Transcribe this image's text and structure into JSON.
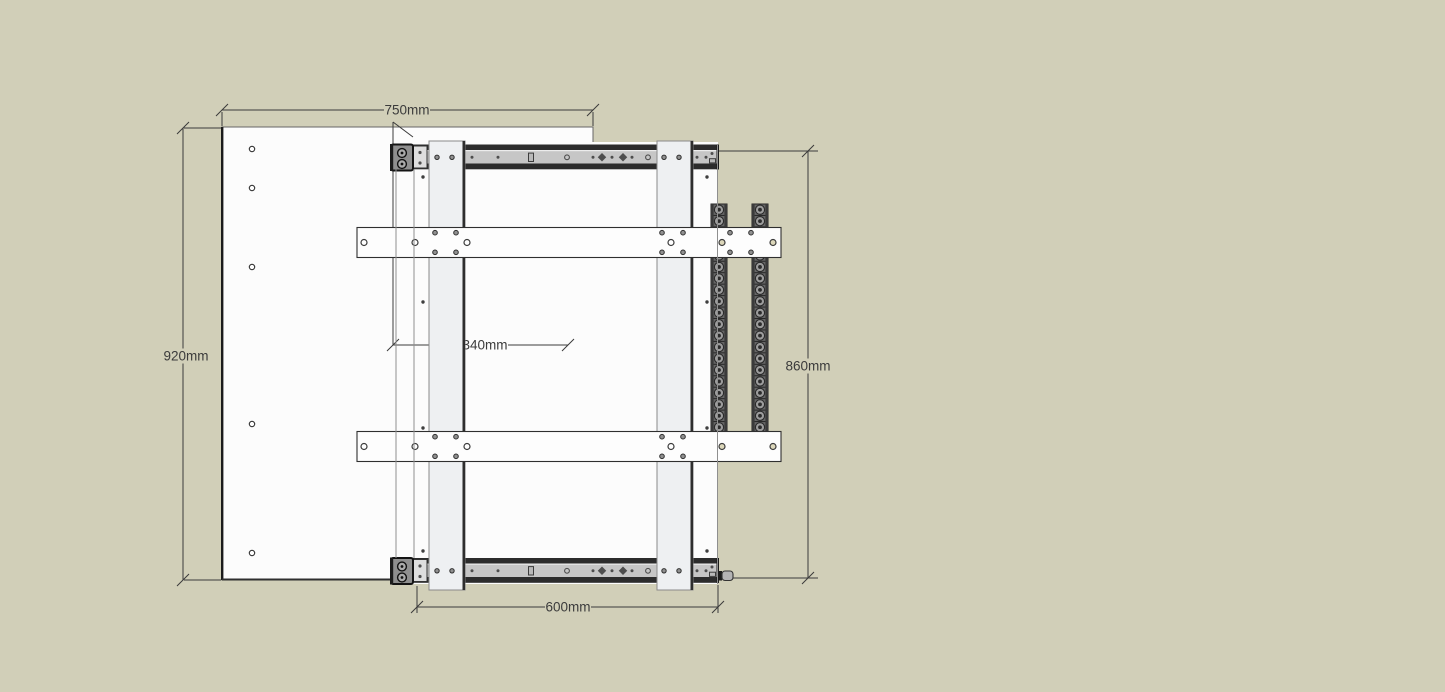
{
  "drawing": {
    "type": "cad-elevation-drawing",
    "units": "mm"
  },
  "dimensions": {
    "top": "750mm",
    "left": "920mm",
    "middle": "340mm",
    "right": "860mm",
    "bottom": "600mm"
  },
  "colors": {
    "bg": "#d1cfb8",
    "panel": "#fcfcfc",
    "dim": "#3b3b3b",
    "dark": "#2c2c2c",
    "railgray": "#c6c6c6",
    "postfill": "#eef0f2",
    "chainbody": "#666666",
    "chainroller": "#9c9c9c",
    "thru": "#dcd7ba"
  }
}
